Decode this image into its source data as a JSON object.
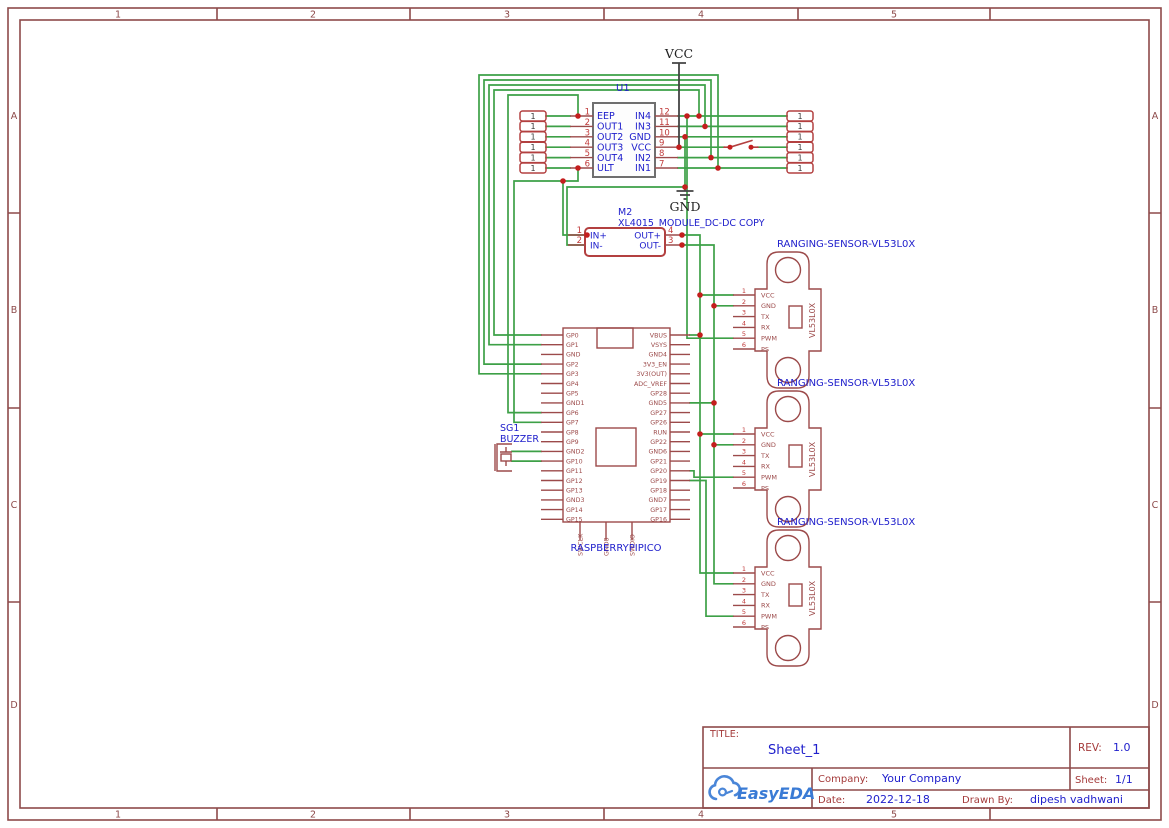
{
  "frame": {
    "cols": [
      "1",
      "2",
      "3",
      "4",
      "5"
    ],
    "rows": [
      "A",
      "B",
      "C",
      "D"
    ]
  },
  "power": {
    "vcc": "VCC",
    "gnd": "GND"
  },
  "u1": {
    "ref": "U1",
    "left_pins": [
      {
        "n": "1",
        "name": "EEP"
      },
      {
        "n": "2",
        "name": "OUT1"
      },
      {
        "n": "3",
        "name": "OUT2"
      },
      {
        "n": "4",
        "name": "OUT3"
      },
      {
        "n": "5",
        "name": "OUT4"
      },
      {
        "n": "6",
        "name": "ULT"
      }
    ],
    "right_pins": [
      {
        "n": "12",
        "name": "IN4"
      },
      {
        "n": "11",
        "name": "IN3"
      },
      {
        "n": "10",
        "name": "GND"
      },
      {
        "n": "9",
        "name": "VCC"
      },
      {
        "n": "8",
        "name": "IN2"
      },
      {
        "n": "7",
        "name": "IN1"
      }
    ]
  },
  "header_pin": "1",
  "m2": {
    "ref": "M2",
    "part": "XL4015_MODULE_DC-DC COPY",
    "left_pins": [
      {
        "n": "1",
        "name": "IN+"
      },
      {
        "n": "2",
        "name": "IN-"
      }
    ],
    "right_pins": [
      {
        "n": "4",
        "name": "OUT+"
      },
      {
        "n": "3",
        "name": "OUT-"
      }
    ]
  },
  "buzzer": {
    "ref": "SG1",
    "label": "BUZZER"
  },
  "pico": {
    "label": "RASPBERRYPIPICO",
    "left_pins": [
      "GP0",
      "GP1",
      "GND",
      "GP2",
      "GP3",
      "GP4",
      "GP5",
      "GND1",
      "GP6",
      "GP7",
      "GP8",
      "GP9",
      "GND2",
      "GP10",
      "GP11",
      "GP12",
      "GP13",
      "GND3",
      "GP14",
      "GP15"
    ],
    "right_pins": [
      "VBUS",
      "VSYS",
      "GND4",
      "3V3_EN",
      "3V3(OUT)",
      "ADC_VREF",
      "GP28",
      "GND5",
      "GP27",
      "GP26",
      "RUN",
      "GP22",
      "GND6",
      "GP21",
      "GP20",
      "GP19",
      "GP18",
      "GND7",
      "GP17",
      "GP16"
    ],
    "bottom_pins": [
      "SWCLK",
      "GND8",
      "SWDIO"
    ]
  },
  "sensor": {
    "label": "RANGING-SENSOR-VL53L0X",
    "chip": "VL53L0X",
    "pins": [
      {
        "n": "1",
        "name": "VCC"
      },
      {
        "n": "2",
        "name": "GND"
      },
      {
        "n": "3",
        "name": "TX"
      },
      {
        "n": "4",
        "name": "RX"
      },
      {
        "n": "5",
        "name": "PWM"
      },
      {
        "n": "6",
        "name": "PS"
      }
    ]
  },
  "title_block": {
    "title_label": "TITLE:",
    "title": "Sheet_1",
    "rev_label": "REV:",
    "rev": "1.0",
    "company_label": "Company:",
    "company": "Your Company",
    "sheet_label": "Sheet:",
    "sheet": "1/1",
    "date_label": "Date:",
    "date": "2022-12-18",
    "drawn_label": "Drawn By:",
    "drawn_by": "dipesh vadhwani",
    "logo": "EasyEDA"
  },
  "colors": {
    "wire": "#3da047",
    "component": "#9c4a4a",
    "header": "#b34040",
    "blue": "#2020cc",
    "pin_number": "#c03a3a",
    "frame": "#8d4a4a",
    "junction": "#c41e1e",
    "logo_blue": "#3a7bd5"
  }
}
